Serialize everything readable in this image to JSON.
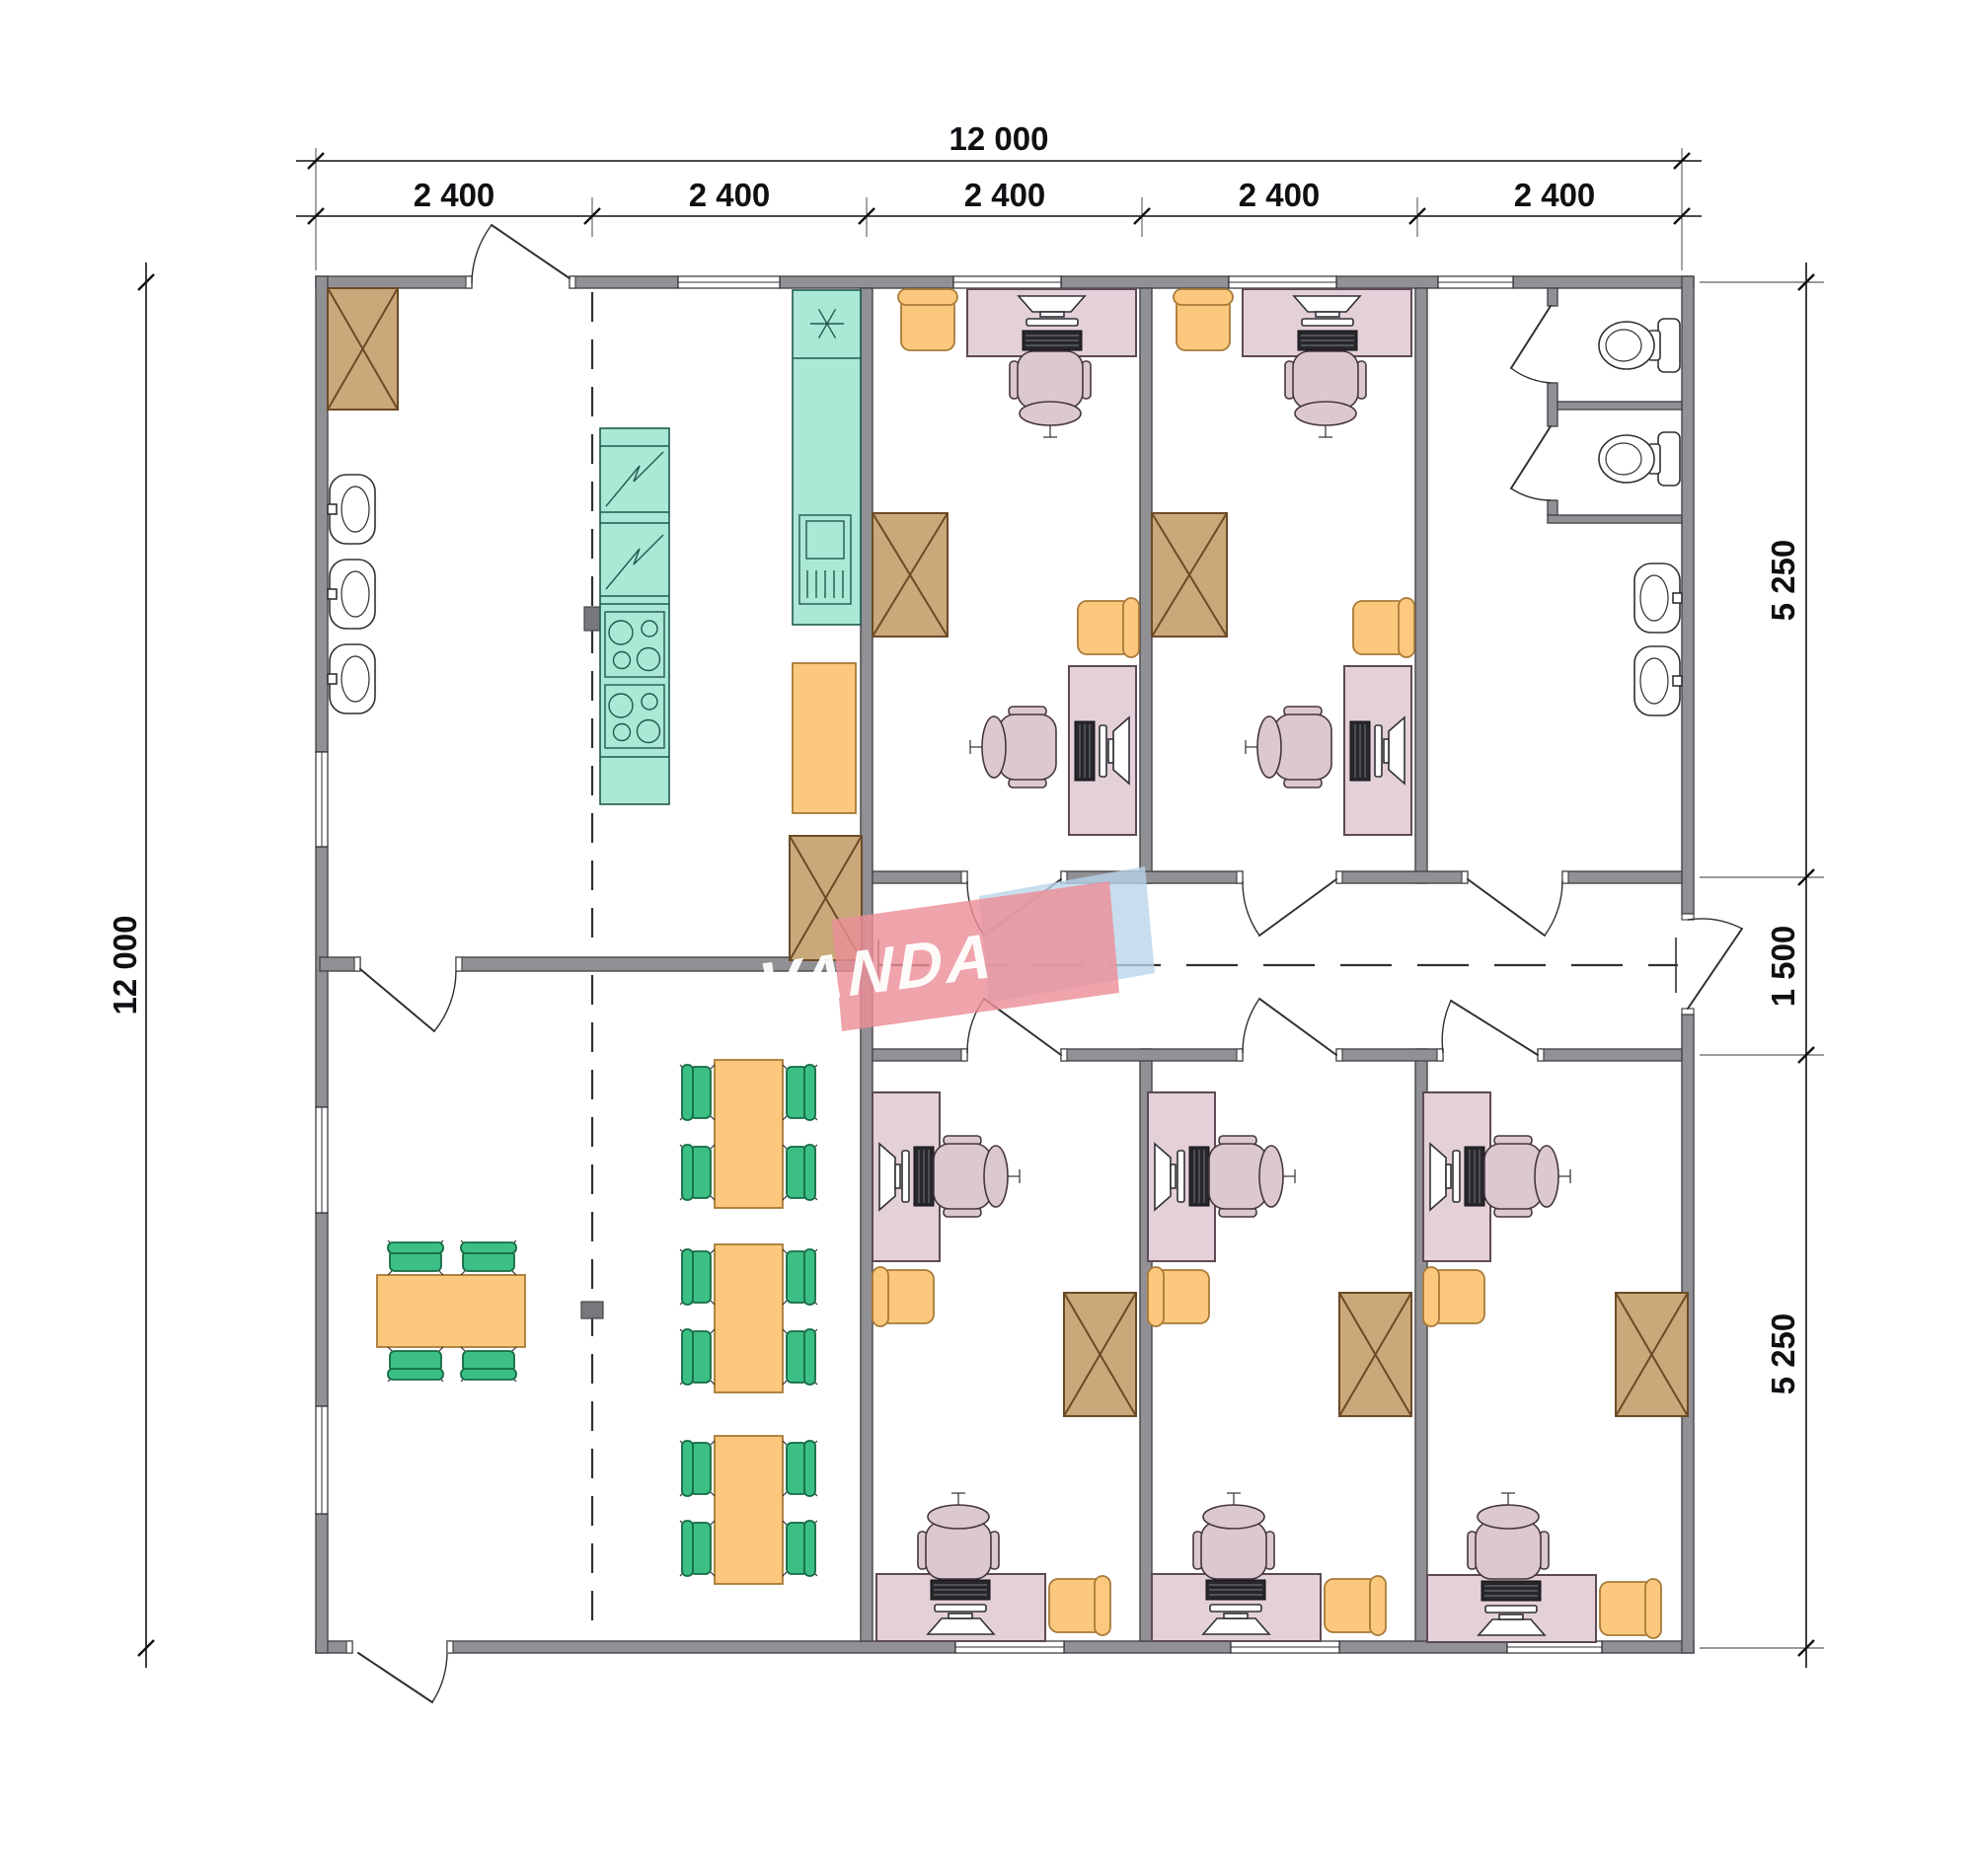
{
  "drawing": {
    "type": "architectural-floor-plan",
    "overall_width_mm": "12 000",
    "overall_height_mm": "12 000"
  },
  "dimensions": {
    "top_total": "12 000",
    "top_segments": [
      "2 400",
      "2 400",
      "2 400",
      "2 400",
      "2 400"
    ],
    "left_total": "12 000",
    "right_segments": [
      "5 250",
      "1 500",
      "5 250"
    ]
  },
  "watermark": {
    "text": "VANDA"
  },
  "colors": {
    "wall": "#909095",
    "wallStroke": "#46464b",
    "line": "#303036",
    "dim": "#101014",
    "teal": "#ace8d6",
    "tealStroke": "#1f5a4b",
    "orange": "#fcc87e",
    "orangeStroke": "#a87a38",
    "cab": "#c9a87a",
    "cabStroke": "#6d4a27",
    "desk": "#e4d0d8",
    "deskStroke": "#5e4a54",
    "chairPink": "#dcc8d0",
    "green": "#3cbf84",
    "greenStroke": "#156a44",
    "column": "#77777c",
    "wmRed": "#ec8f97",
    "wmBlue": "#b9d5eb",
    "wmText": "#ffffff"
  }
}
